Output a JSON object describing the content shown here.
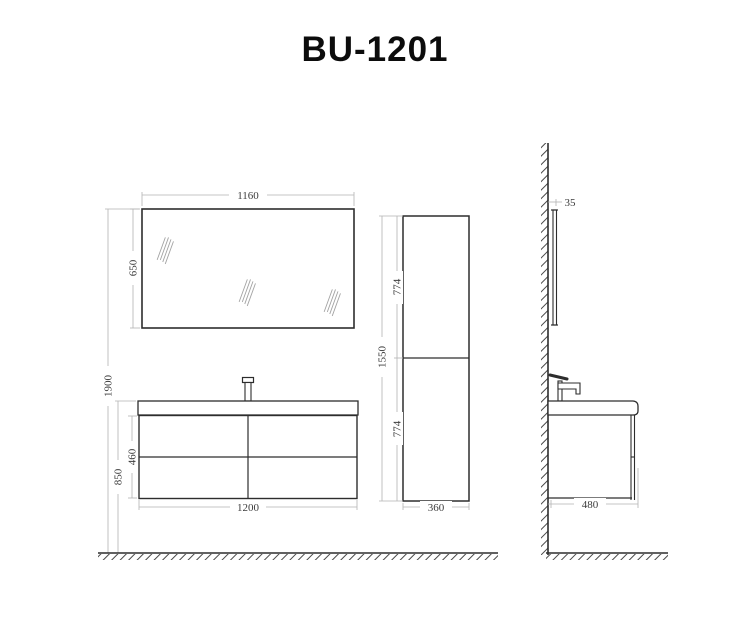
{
  "title": "BU-1201",
  "views": {
    "front": "front-elevation",
    "column": "side-column-cabinet",
    "side": "side-profile-at-wall"
  },
  "dims": {
    "mirror_width": "1160",
    "mirror_height": "650",
    "total_height": "1900",
    "vanity_height": "850",
    "drawer_section_height": "460",
    "vanity_width": "1200",
    "column_height": "1550",
    "column_upper": "774",
    "column_lower": "774",
    "column_width": "360",
    "mirror_depth": "35",
    "vanity_depth": "480"
  },
  "colors": {
    "line": "#2d2d2d",
    "dimension": "#b3b3b3",
    "dim_text": "#3c3c3c",
    "background": "#ffffff"
  }
}
